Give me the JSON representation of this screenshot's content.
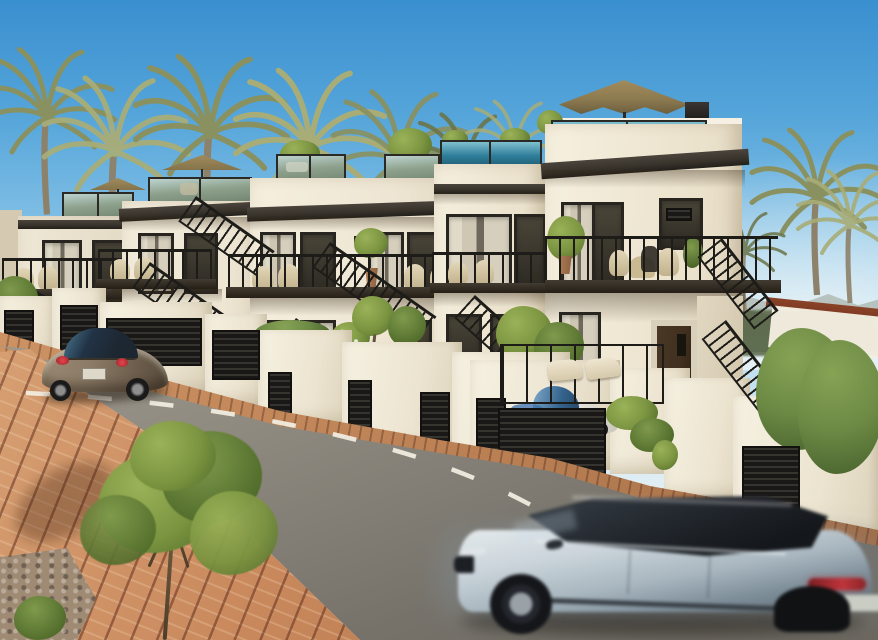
{
  "scene": {
    "type": "architectural-exterior-render",
    "description": "Sunny render of a row of modern white townhouses with rooftop glass terraces, tan patio umbrella, black exterior stairs, palm trees, a street with dashed centre line, brick sidewalk, a parked bronze hatchback, a white city car behind a louvered gate and a motion-blurred silver SUV driving past in the foreground",
    "objects": [
      {
        "label": "Clear blue sky"
      },
      {
        "label": "Hazy horizon light"
      },
      {
        "label": "Distant hills"
      },
      {
        "label": "Palm trees"
      },
      {
        "label": "Row of white townhouses with rooftop terraces and balconies"
      },
      {
        "label": "Tan patio umbrella on rooftop terrace"
      },
      {
        "label": "Black exterior staircases"
      },
      {
        "label": "White garden walls with dark louvered gates and garage doors"
      },
      {
        "label": "Asphalt street"
      },
      {
        "label": "White dashed centre line"
      },
      {
        "label": "Brick paved sidewalk"
      },
      {
        "label": "Young street tree"
      },
      {
        "label": "Parked bronze hatchback"
      },
      {
        "label": "White city car behind gate"
      },
      {
        "label": "Silver-blue SUV driving past with motion blur"
      },
      {
        "label": "Green hedge"
      }
    ]
  },
  "palette": {
    "sky_top": "#3a8fcf",
    "sky_mid": "#8ec7e8",
    "sky_low": "#d6e9f3",
    "hill_far": "#97a191",
    "hill_near": "#55604b",
    "veg_distant": "#5e6c4d",
    "palm_light": "#a8ad77",
    "palm_mid": "#8a9160",
    "palm_dark": "#6b7447",
    "palm_trunk": "#8d8169",
    "wall_white": "#f5f0e3",
    "wall_light": "#eee6d3",
    "wall_mid": "#e4dbc6",
    "wall_shade": "#d5c9b1",
    "fascia": "#37322a",
    "frame": "#282520",
    "glass_teal": "#2f7e99",
    "glass_green": "#8da08b",
    "louver": "#1a1917",
    "rail": "#1d1c19",
    "road": "#a19c90",
    "road_dark": "#76726a",
    "dash": "#f3efe3",
    "curb": "#b97f53",
    "brick": "#c9895d",
    "brick_dark": "#a5683f",
    "brick_light": "#dca87a",
    "foliage": "#7b9440",
    "foliage_light": "#9ab258",
    "foliage_dark": "#546f2d",
    "hedge": "#6d8a45",
    "hedge_dark": "#46602c",
    "umbrella": "#8d7b50",
    "umbrella_dark": "#6d5f3e",
    "beetle_body": "#8a7a66",
    "beetle_dark": "#564a3b",
    "car_glass": "#1d2731",
    "white_car": "#f0efe9",
    "wcar_glass": "#35648e",
    "suv_body": "#c9d3d9",
    "suv_dark": "#5f6f7a",
    "suv_glass": "#23282e",
    "taillight": "#c4333a",
    "door_brown": "#41301f",
    "red_cap": "#7e3b24",
    "wicker": "#d8cba8",
    "pot": "#9c6b4b"
  }
}
